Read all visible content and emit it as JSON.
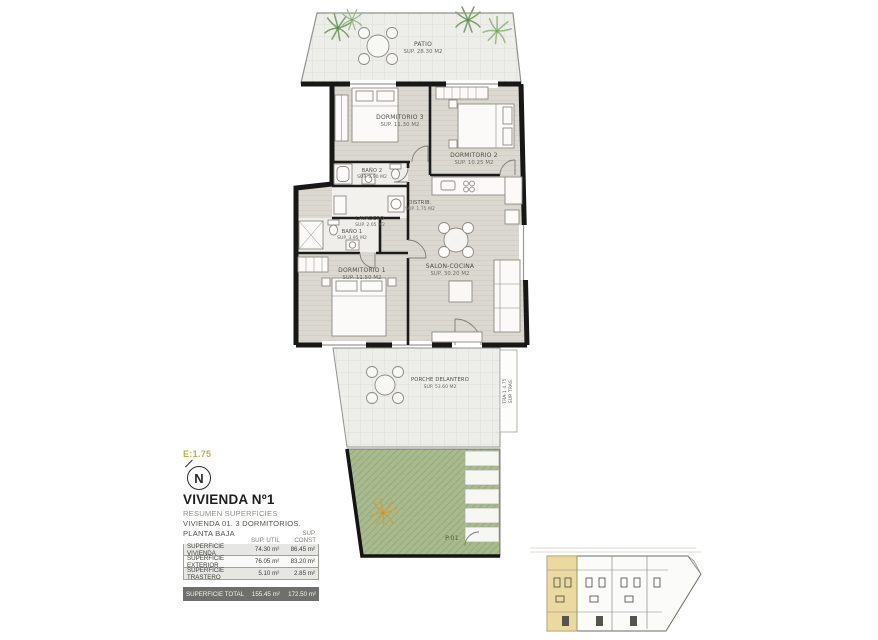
{
  "meta": {
    "scale_label": "E:1.75",
    "north_label": "N"
  },
  "title_block": {
    "title": "VIVIENDA Nº1",
    "subtitle1": "RESUMEN SUPERFICIES",
    "subtitle2": "VIVIENDA 01. 3 DORMITORIOS.",
    "subtitle3": "PLANTA BAJA"
  },
  "table": {
    "col_util": "SUP. UTIL",
    "col_const": "SUP. CONST",
    "rows": [
      {
        "label": "SUPERFICIE VIVIENDA",
        "util": "74.30 m²",
        "const": "86.45 m²"
      },
      {
        "label": "SUPERFICIE EXTERIOR",
        "util": "76.05 m²",
        "const": "83.20 m²"
      },
      {
        "label": "SUPERFICIE TRASTERO",
        "util": "5.10 m²",
        "const": "2.85 m²"
      }
    ],
    "total": {
      "label": "SUPERFICIE TOTAL",
      "util": "155.45 m²",
      "const": "172.50 m²"
    }
  },
  "rooms": {
    "patio": {
      "name": "PATIO",
      "area": "SUP. 28.30 M2"
    },
    "dorm3": {
      "name": "DORMITORIO 3",
      "area": "SUP. 11.30 M2"
    },
    "dorm2": {
      "name": "DORMITORIO 2",
      "area": "SUP. 10.25 M2"
    },
    "bano2": {
      "name": "BAÑO 2",
      "area": "SUP. 3.90 M2"
    },
    "distrib": {
      "name": "DISTRIB.",
      "area": "SUP. 1.75 M2"
    },
    "lavadero": {
      "name": "LAVADERO",
      "area": "SUP. 2.05 M2"
    },
    "bano1": {
      "name": "BAÑO 1",
      "area": "SUP. 3.95 M2"
    },
    "dorm1": {
      "name": "DORMITORIO 1",
      "area": "SUP. 11.50 M2"
    },
    "salon": {
      "name": "SALON-COCINA",
      "area": "SUP. 30.20 M2"
    },
    "porche": {
      "name": "PORCHE DELANTERO",
      "area": "SUP. 53.60 M2"
    },
    "parcela": {
      "name": "P.01"
    },
    "trastero": {
      "line1": "TRA-1 4.75",
      "line2": "SUP. TRAS."
    }
  },
  "colors": {
    "garden_green": "#a9ba8e",
    "minimap_highlight": "#ead9a0",
    "scale_accent": "#b8b24c",
    "wall": "#171716",
    "wood_floor": "#dbd7d1",
    "tile_floor": "#ededea"
  }
}
